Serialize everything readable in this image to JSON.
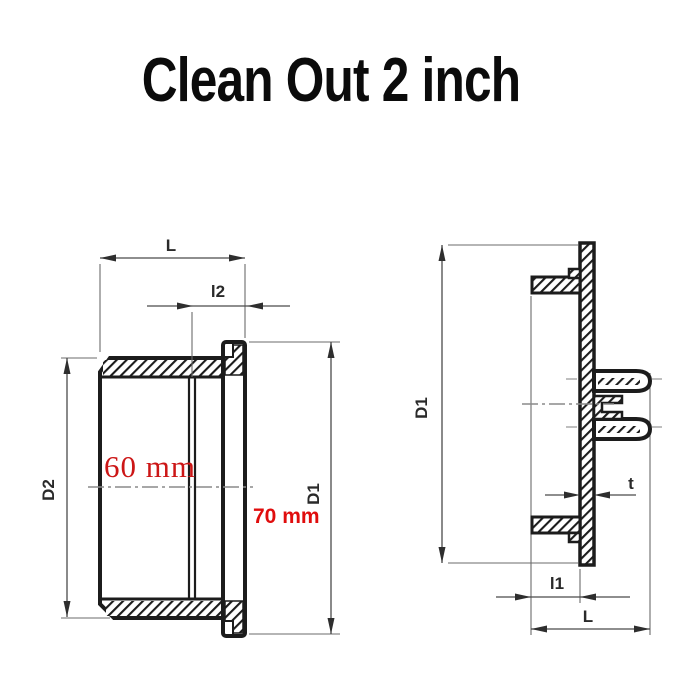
{
  "title": "Clean Out 2 inch",
  "colors": {
    "outline": "#1c1c1c",
    "dimension_lines": "#4b4b4b",
    "centerline": "#8a8a8a",
    "red_inner_diameter": "#cc1616",
    "red_outer_diameter": "#e00d0d",
    "background": "#ffffff",
    "title_text": "#0b0b0b"
  },
  "views": {
    "left": {
      "name": "socket body side section",
      "dims": {
        "length": "L",
        "socket_depth": "l2",
        "body_diameter": "D2",
        "flange_diameter": "D1"
      },
      "measurements": {
        "inner_diameter": "60 mm",
        "outer_diameter": "70 mm"
      }
    },
    "right": {
      "name": "cleanout plug side section",
      "dims": {
        "flange_diameter": "D1",
        "wall_thickness": "t",
        "hub_depth": "l1",
        "length": "L"
      }
    }
  }
}
